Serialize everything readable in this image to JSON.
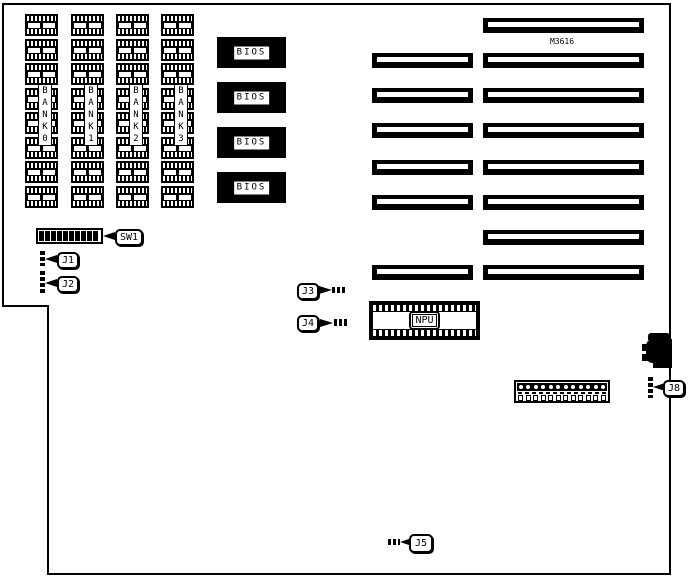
{
  "colors": {
    "ink": "#000000",
    "paper": "#ffffff"
  },
  "diagram": {
    "model_label": "M3616",
    "memory": {
      "chips_per_bank": 8,
      "banks": [
        {
          "label": "BANK 0"
        },
        {
          "label": "BANK 1"
        },
        {
          "label": "BANK 2"
        },
        {
          "label": "BANK 3"
        }
      ]
    },
    "bios": {
      "label": "BIOS",
      "count": 4
    },
    "npu": {
      "label": "NPU"
    },
    "dip_switch": {
      "label": "SW1",
      "positions": 10
    },
    "jumpers": [
      {
        "id": "J1",
        "pins": 3
      },
      {
        "id": "J2",
        "pins": 5
      },
      {
        "id": "J3",
        "pins": 3
      },
      {
        "id": "J4",
        "pins": 3
      },
      {
        "id": "J5",
        "pins": 3
      },
      {
        "id": "J8",
        "pins": 4
      }
    ],
    "expansion_slots": {
      "rows": [
        {
          "sixteen_bit": false
        },
        {
          "sixteen_bit": true
        },
        {
          "sixteen_bit": true
        },
        {
          "sixteen_bit": true
        },
        {
          "sixteen_bit": true
        },
        {
          "sixteen_bit": true
        },
        {
          "sixteen_bit": false
        },
        {
          "sixteen_bit": true
        }
      ]
    },
    "power_connector": {
      "pins": 12
    },
    "keyboard_connector": {
      "present": true
    }
  }
}
